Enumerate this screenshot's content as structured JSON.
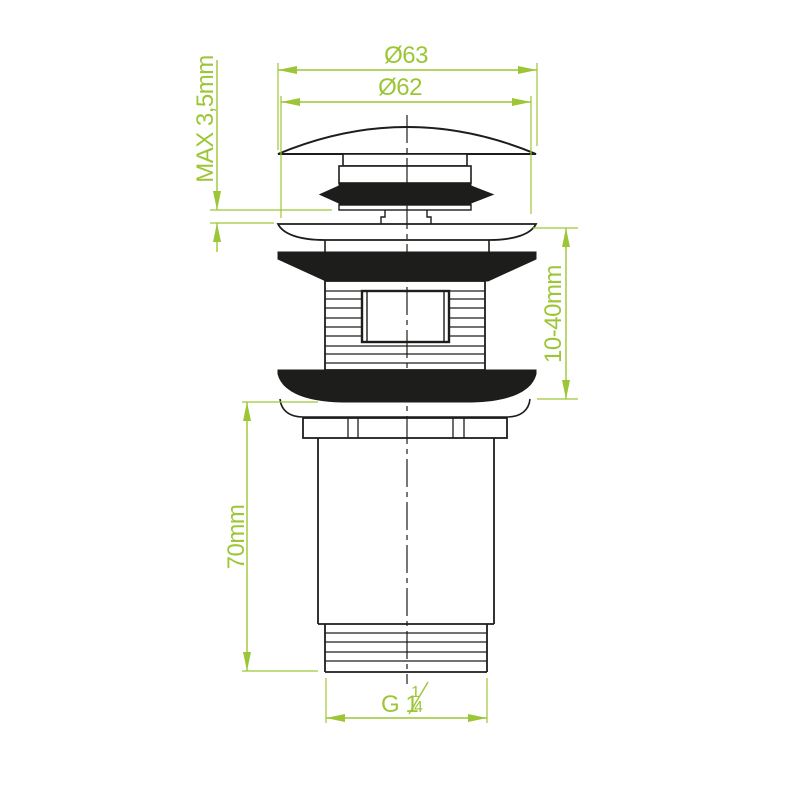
{
  "colors": {
    "dimension_green": "#9cc636",
    "outline_black": "#1d1d1b",
    "background": "#ffffff"
  },
  "dimensions": {
    "cap_diameter": {
      "label": "Ø63"
    },
    "plug_diameter": {
      "label": "Ø62"
    },
    "max_gap": {
      "label": "MAX 3,5mm"
    },
    "clamping_range": {
      "label": "10-40mm"
    },
    "body_length": {
      "label": "70mm"
    },
    "thread_size": {
      "label": "G 1¼",
      "prefix": "G 1",
      "numerator": "1",
      "denominator": "4"
    }
  }
}
